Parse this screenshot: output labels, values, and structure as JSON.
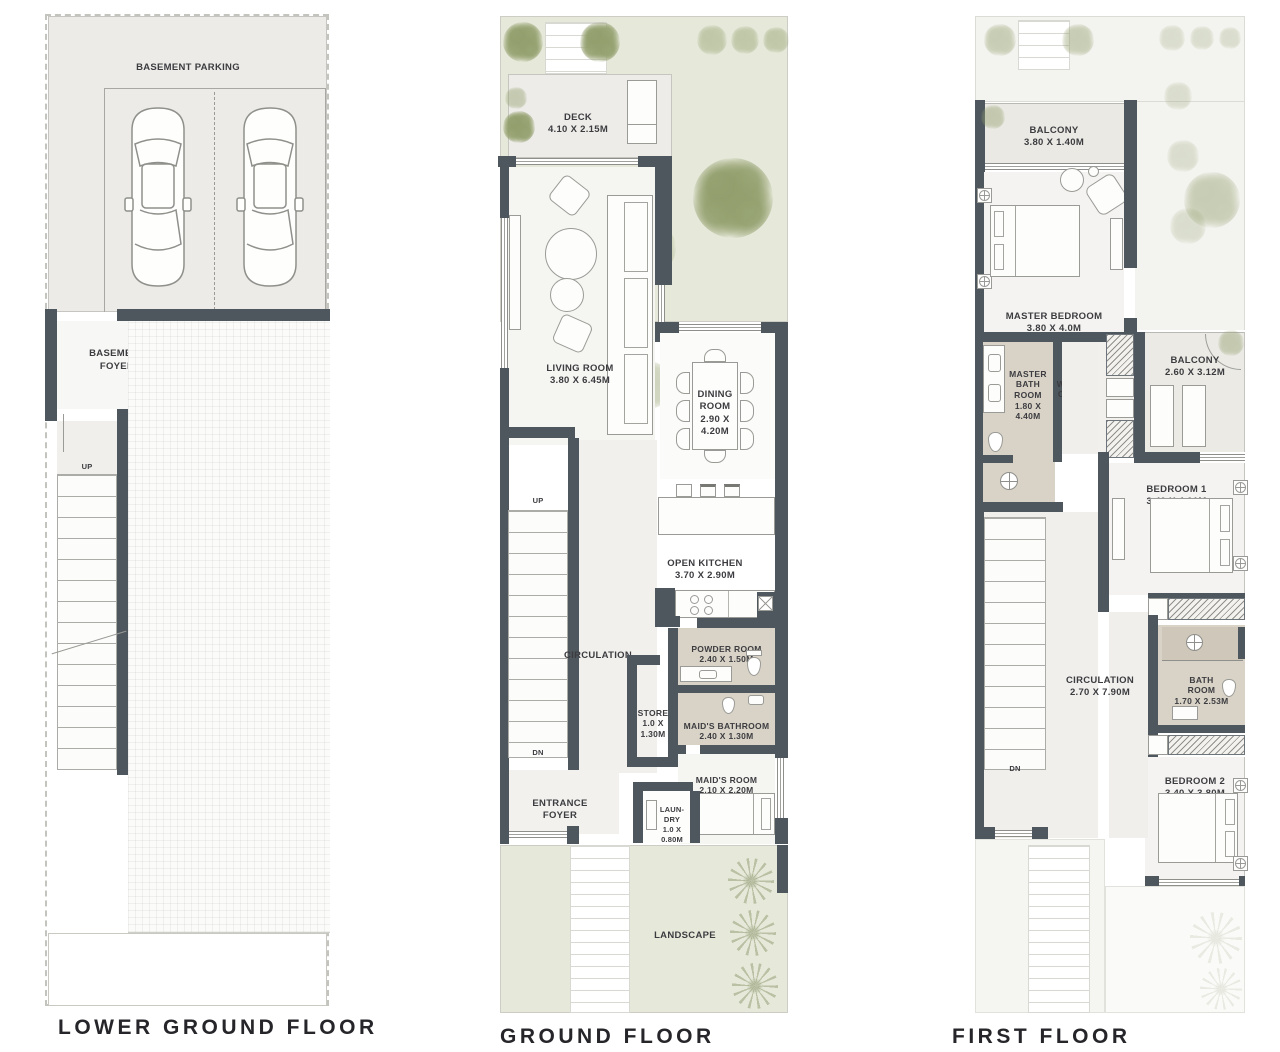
{
  "floors": {
    "lower_ground": {
      "title": "LOWER GROUND FLOOR",
      "labels": {
        "basement_parking": "BASEMENT PARKING",
        "basement_foyer": "BASEMENT\nFOYER",
        "stairs_up": "UP"
      }
    },
    "ground": {
      "title": "GROUND FLOOR",
      "rooms": {
        "deck": {
          "name": "DECK",
          "dims": "4.10 X 2.15M"
        },
        "living_room": {
          "name": "LIVING ROOM",
          "dims": "3.80 X 6.45M"
        },
        "dining_room": {
          "name": "DINING\nROOM",
          "dims": "2.90 X\n4.20M"
        },
        "open_kitchen": {
          "name": "OPEN KITCHEN",
          "dims": "3.70 X 2.90M"
        },
        "circulation": {
          "name": "CIRCULATION"
        },
        "powder_room": {
          "name": "POWDER ROOM",
          "dims": "2.40 X 1.50M"
        },
        "store": {
          "name": "STORE",
          "dims": "1.0 X\n1.30M"
        },
        "maids_bathroom": {
          "name": "MAID'S BATHROOM",
          "dims": "2.40 X 1.30M"
        },
        "maids_room": {
          "name": "MAID'S ROOM",
          "dims": "2.10 X 2.20M"
        },
        "entrance_foyer": {
          "name": "ENTRANCE\nFOYER"
        },
        "laundry": {
          "name": "LAUN-\nDRY",
          "dims": "1.0 X\n0.80M"
        },
        "landscape": {
          "name": "LANDSCAPE"
        },
        "stairs_up": "UP",
        "stairs_dn": "DN"
      }
    },
    "first": {
      "title": "FIRST FLOOR",
      "rooms": {
        "balcony_front": {
          "name": "BALCONY",
          "dims": "3.80 X 1.40M"
        },
        "master_bedroom": {
          "name": "MASTER BEDROOM",
          "dims": "3.80 X 4.0M"
        },
        "master_bathroom": {
          "name": "MASTER\nBATH\nROOM",
          "dims": "1.80 X\n4.40M"
        },
        "walk_in_closet": {
          "name": "WALK-IN\nCLOSET",
          "dims": "1.85 X\n3.08M"
        },
        "balcony_rear": {
          "name": "BALCONY",
          "dims": "2.60 X 3.12M"
        },
        "bedroom1": {
          "name": "BEDROOM 1",
          "dims": "3.40 X 4.01M"
        },
        "circulation": {
          "name": "CIRCULATION",
          "dims": "2.70 X 7.90M"
        },
        "bathroom": {
          "name": "BATH\nROOM",
          "dims": "1.70 X 2.53M"
        },
        "bedroom2": {
          "name": "BEDROOM 2",
          "dims": "3.40 X 3.80M"
        },
        "stairs_dn": "DN"
      }
    }
  },
  "colors": {
    "wall": "#4e575d",
    "garden": "#e6e9da",
    "tree": "#a3ad80",
    "bath_floor": "#d9d3c7",
    "room_floor": "#f4f3f1",
    "parking": "#ecebe7"
  }
}
